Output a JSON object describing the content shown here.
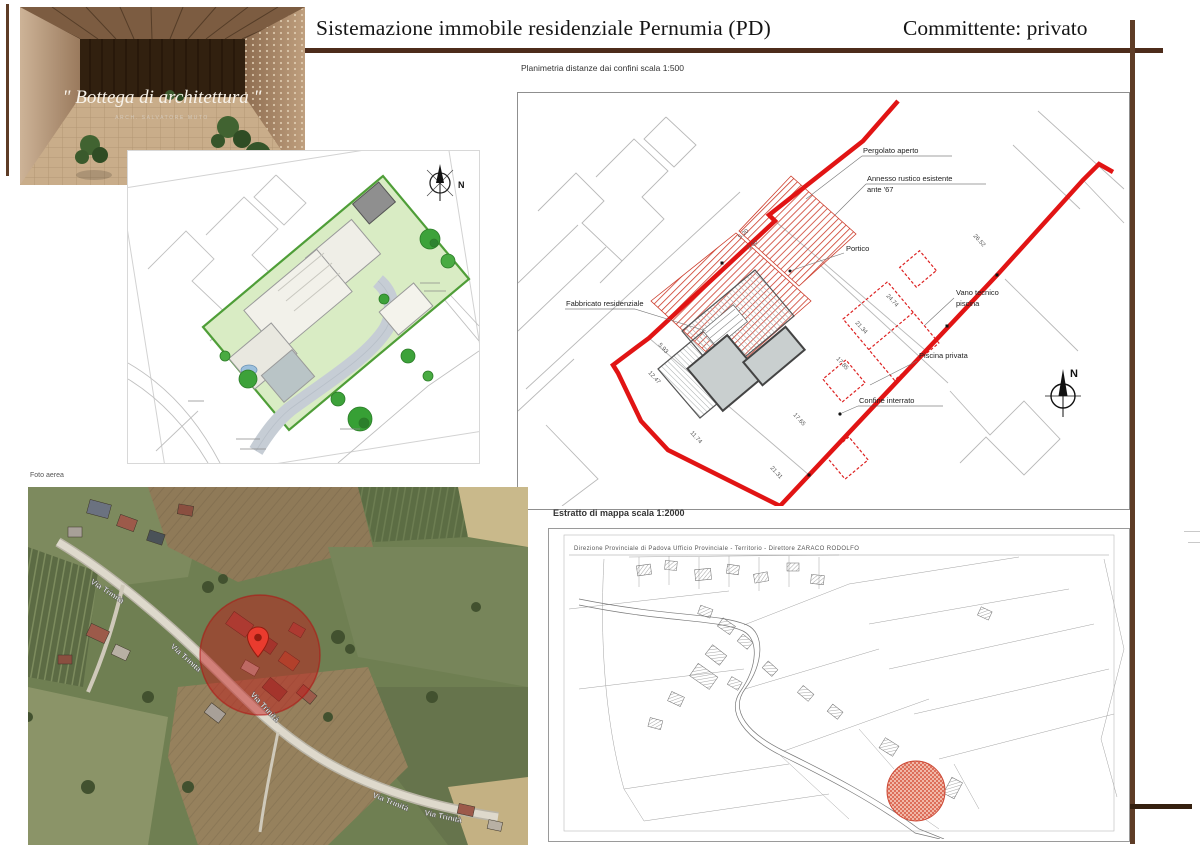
{
  "header": {
    "title": "Sistemazione immobile residenziale Pernumia (PD)",
    "client": "Committente: privato"
  },
  "logo": {
    "quote": "\" Bottega di architettura \"",
    "subtitle": "ARCH. SALVATORE MUTO"
  },
  "site_plan": {
    "compass_n": "N"
  },
  "tech_plan": {
    "caption": "Planimetria distanze dai confini scala 1:500",
    "compass_n": "N",
    "labels": {
      "pergolato": "Pergolato aperto",
      "annesso1": "Annesso rustico esistente",
      "annesso2": "ante '67",
      "portico": "Portico",
      "vano1": "Vano tecnico",
      "vano2": "piscina",
      "piscina": "Piscina privata",
      "confine": "Confine interrato",
      "fabbricato": "Fabbricato residenziale"
    },
    "dimensions": [
      "5.20",
      "3.60",
      "26.52",
      "24.74",
      "21.34",
      "17.85",
      "12.47",
      "11.74",
      "17.65",
      "21.31",
      "5.93"
    ]
  },
  "aerial": {
    "caption": "Foto aerea",
    "road_label": "Via Trinità"
  },
  "cadastral": {
    "caption": "Estratto di mappa scala 1:2000",
    "header": "Direzione Provinciale di Padova  Ufficio Provinciale - Territorio - Direttore ZARACO RODOLFO"
  },
  "colors": {
    "frame_brown": "#5e3c26",
    "boundary_red": "#e11414"
  }
}
